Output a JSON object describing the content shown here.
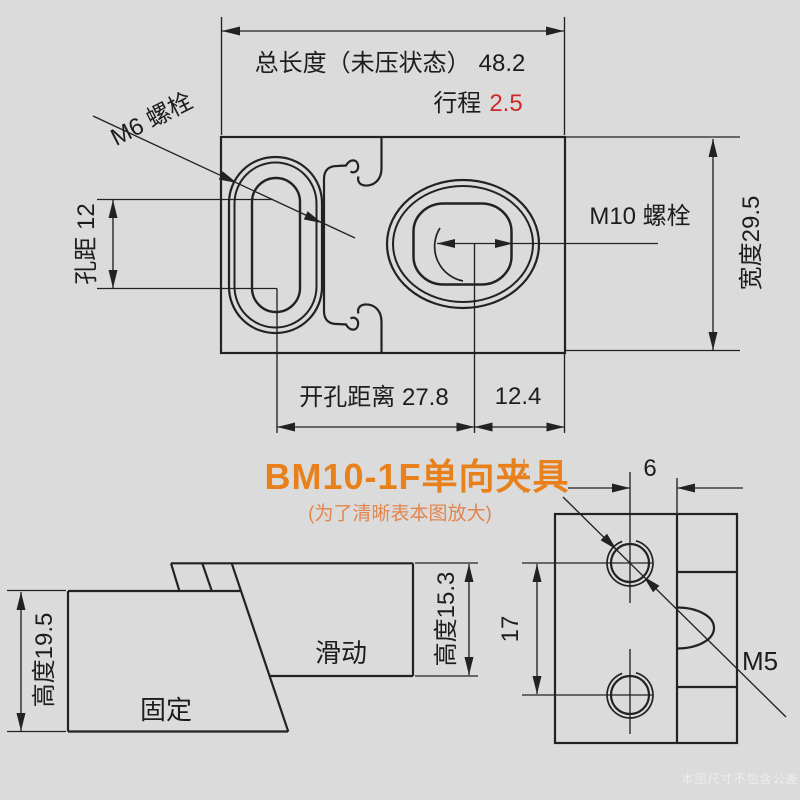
{
  "colors": {
    "background": "#dbdbdb",
    "line": "#222222",
    "text": "#1d1d1d",
    "stroke_value_red": "#cb2a28",
    "title_orange": "#e8811c",
    "subtitle_orange": "#e2854e",
    "logo_orange": "#e8851c"
  },
  "top_view": {
    "total_length_label": "总长度（未压状态）",
    "total_length_value": "48.2",
    "stroke_label": "行程",
    "stroke_value": "2.5",
    "m6_bolt": "M6 螺栓",
    "hole_pitch": "孔距 12",
    "m10_bolt": "M10 螺栓",
    "width": "宽度29.5",
    "opening_distance": "开孔距离 27.8",
    "edge_distance": "12.4"
  },
  "title": {
    "text": "BM10-1F单向夹具",
    "subtitle": "(为了清晰表本图放大)"
  },
  "side_view": {
    "fixed_height": "高度19.5",
    "fixed": "固定",
    "sliding": "滑动",
    "sliding_height": "高度15.3"
  },
  "end_view": {
    "hole_offset": "6",
    "hole_spacing": "17",
    "m5_bolt": "M5"
  },
  "watermarks": {
    "logo": "夹具",
    "disclaimer": "本图尺寸不包含公差"
  }
}
